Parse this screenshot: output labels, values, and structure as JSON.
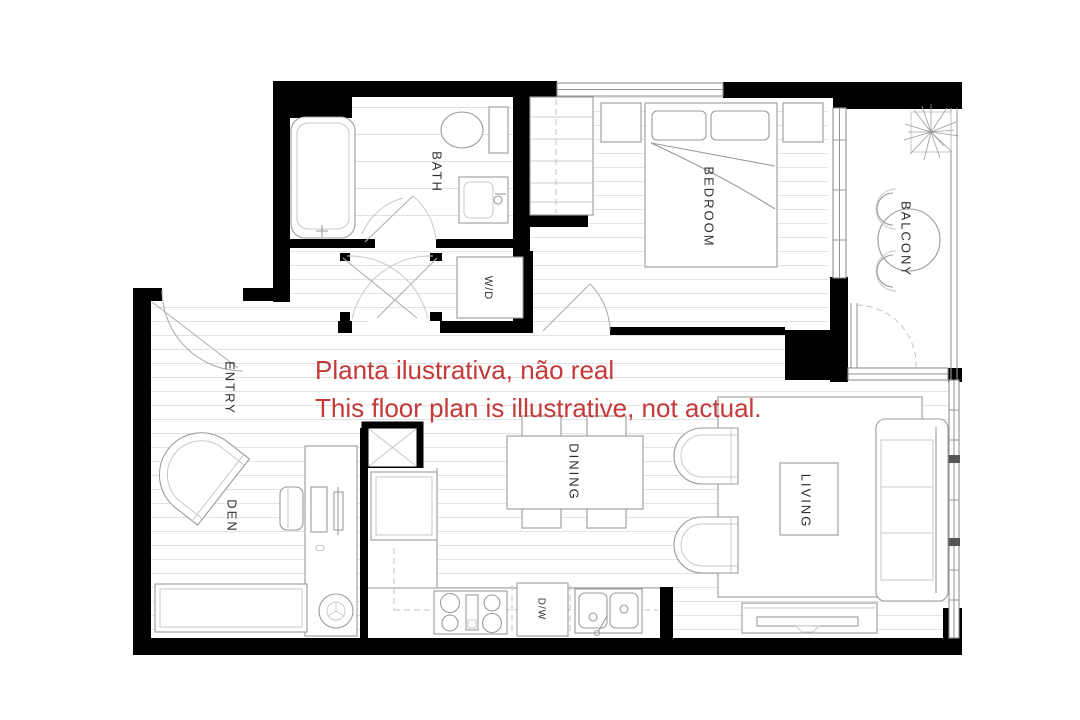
{
  "canvas": {
    "width": 1080,
    "height": 720,
    "background": "#FFFFFF"
  },
  "colors": {
    "wall": "#000000",
    "floor_hatch": "#E3E3E3",
    "fixture_line": "#9B9B9B",
    "label_text": "#2F2F2F",
    "disclaimer_text": "#C63939"
  },
  "rooms": {
    "bath": {
      "label": "BATH"
    },
    "laundry": {
      "label": "W/D"
    },
    "entry": {
      "label": "ENTRY"
    },
    "den": {
      "label": "DEN"
    },
    "bedroom": {
      "label": "BEDROOM"
    },
    "balcony": {
      "label": "BALCONY"
    },
    "dining": {
      "label": "DINING"
    },
    "living": {
      "label": "LIVING"
    },
    "dishwasher": {
      "label": "D/W"
    }
  },
  "disclaimer": {
    "line1": "Planta ilustrativa, não real",
    "line2": "This floor plan is illustrative, not actual."
  },
  "fixtures": [
    "bathtub",
    "toilet",
    "vanity-sink",
    "washer-dryer",
    "closet-rod",
    "queen-bed",
    "pillows",
    "nightstand-left",
    "nightstand-right",
    "balcony-table",
    "balcony-chairs",
    "potted-plant",
    "entry-armchair",
    "desk",
    "desk-chair",
    "monitor",
    "bookshelf",
    "stool",
    "refrigerator",
    "cooktop",
    "kitchen-sink",
    "shaft-box",
    "dining-table",
    "dining-chairs",
    "area-rug",
    "lounge-chair-top",
    "lounge-chair-bottom",
    "coffee-table",
    "sofa",
    "tv-console"
  ]
}
